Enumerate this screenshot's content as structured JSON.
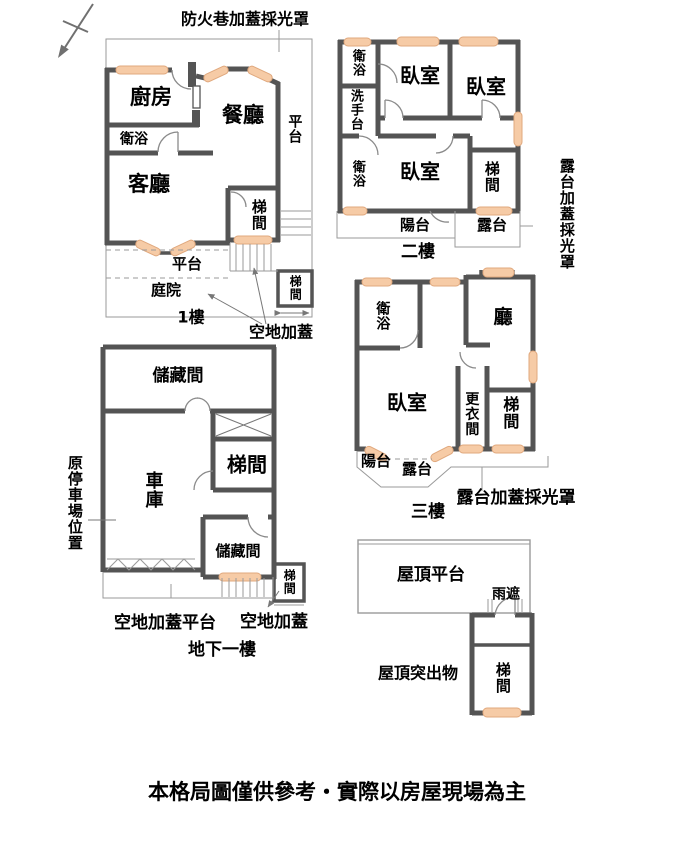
{
  "top_note": "防火巷加蓋採光罩",
  "disclaimer": "本格局圖僅供參考・實際以房屋現場為主",
  "colors": {
    "wall": "#545454",
    "window": "#F6CBA6",
    "window_border": "#E0A87D",
    "thin_line": "#9A9A9A"
  },
  "floor1": {
    "name": "1樓",
    "kitchen": "廚房",
    "dining": "餐廳",
    "bath": "衛浴",
    "living": "客廳",
    "stair": "梯間",
    "stair2": "梯間",
    "platform_right": "平台",
    "platform_bottom": "平台",
    "courtyard": "庭院",
    "covered_note": "空地加蓋"
  },
  "floor2": {
    "name": "二樓",
    "bath_top": "衛浴",
    "washbasin": "洗手台",
    "bedroom1": "臥室",
    "bedroom2": "臥室",
    "bedroom3": "臥室",
    "bath_bottom": "衛浴",
    "stair": "梯間",
    "balcony": "陽台",
    "terrace": "露台",
    "side_note": "露台加蓋採光罩"
  },
  "floor3": {
    "name": "三樓",
    "bath": "衛浴",
    "hall": "廳",
    "bedroom": "臥室",
    "closet": "更衣間",
    "stair": "梯間",
    "balcony": "陽台",
    "terrace": "露台",
    "note": "露台加蓋採光罩"
  },
  "basement": {
    "name": "地下一樓",
    "storage_top": "儲藏間",
    "garage": "車庫",
    "stair": "梯間",
    "storage_br": "儲藏間",
    "stair_outside": "梯間",
    "side_note": "原停車場位置",
    "platform_note": "空地加蓋平台",
    "covered_note": "空地加蓋"
  },
  "roof": {
    "platform": "屋頂平台",
    "rain_cover": "雨遮",
    "protrusion": "屋頂突出物",
    "stair": "梯間"
  }
}
